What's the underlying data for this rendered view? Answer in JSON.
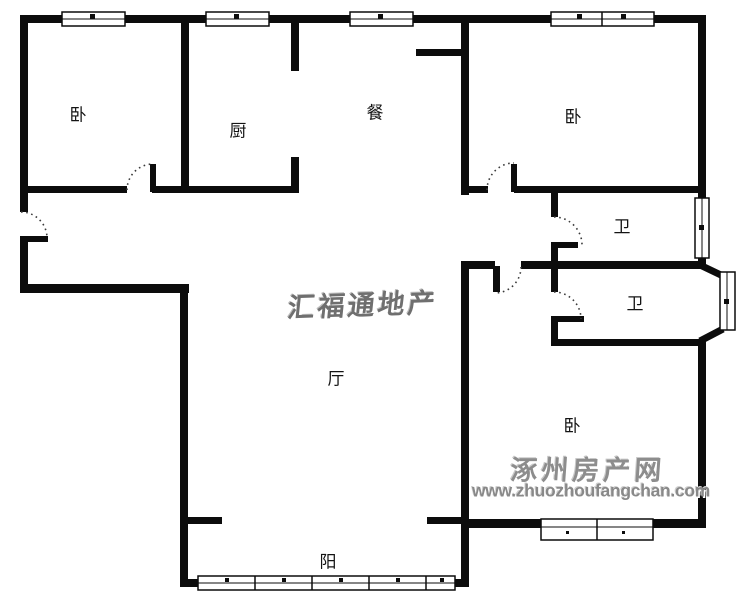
{
  "document": {
    "type": "apartment-floorplan"
  },
  "rooms": [
    {
      "id": "bedroom-1",
      "label": "卧"
    },
    {
      "id": "kitchen",
      "label": "厨"
    },
    {
      "id": "dining",
      "label": "餐"
    },
    {
      "id": "bedroom-2",
      "label": "卧"
    },
    {
      "id": "bathroom-1",
      "label": "卫"
    },
    {
      "id": "bathroom-2",
      "label": "卫"
    },
    {
      "id": "bedroom-3",
      "label": "卧"
    },
    {
      "id": "living-room",
      "label": "厅"
    },
    {
      "id": "balcony",
      "label": "阳"
    }
  ],
  "watermarks": {
    "agency": "汇福通地产",
    "site_name": "涿州房产网",
    "site_url": "www.zhuozhoufangchan.com"
  },
  "colors": {
    "wall": "#0c0c0c",
    "background": "#ffffff",
    "watermark_gray": "#8a8a8a"
  }
}
